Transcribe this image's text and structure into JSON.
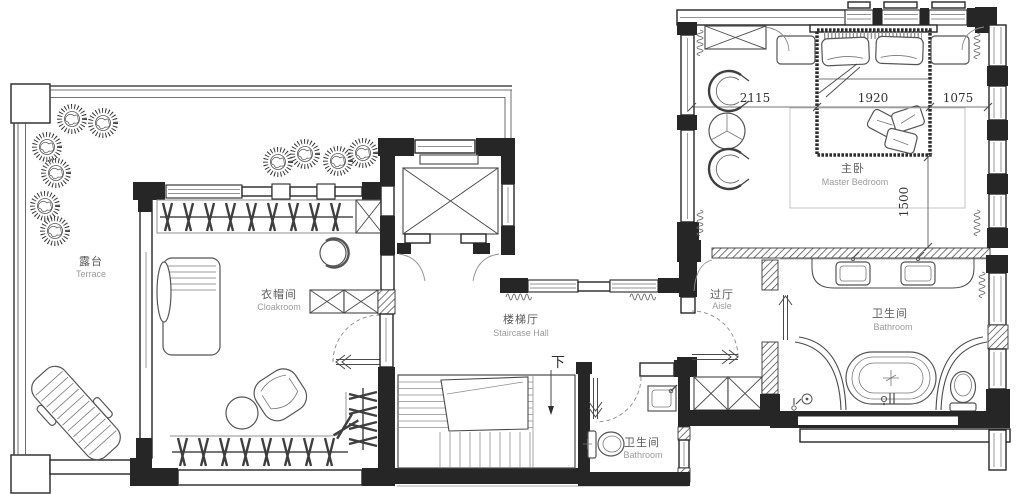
{
  "plan": {
    "type": "residential-floor-plan",
    "rooms": {
      "terrace": {
        "zh": "露台",
        "en": "Terrace"
      },
      "cloakroom": {
        "zh": "衣帽间",
        "en": "Cloakroom"
      },
      "staircase_hall": {
        "zh": "楼梯厅",
        "en": "Staircase Hall"
      },
      "stair_bathroom": {
        "zh": "卫生间",
        "en": "Bathroom"
      },
      "aisle": {
        "zh": "过厅",
        "en": "Aisle"
      },
      "master_bedroom": {
        "zh": "主卧",
        "en": "Master Bedroom"
      },
      "master_bathroom": {
        "zh": "卫生间",
        "en": "Bathroom"
      }
    },
    "dimensions": {
      "bed_left_mm": "2115",
      "bed_width_mm": "1920",
      "bed_right_mm": "1075",
      "bed_side_mm": "1500"
    },
    "stairs": {
      "direction_label": "下"
    },
    "colors": {
      "wall": "#262626",
      "line": "#4a4a4a",
      "furniture_line": "#555555",
      "label_zh": "#5a5a5a",
      "label_en": "#9a9a9a",
      "dimension_text": "#333333",
      "background": "#ffffff"
    }
  }
}
